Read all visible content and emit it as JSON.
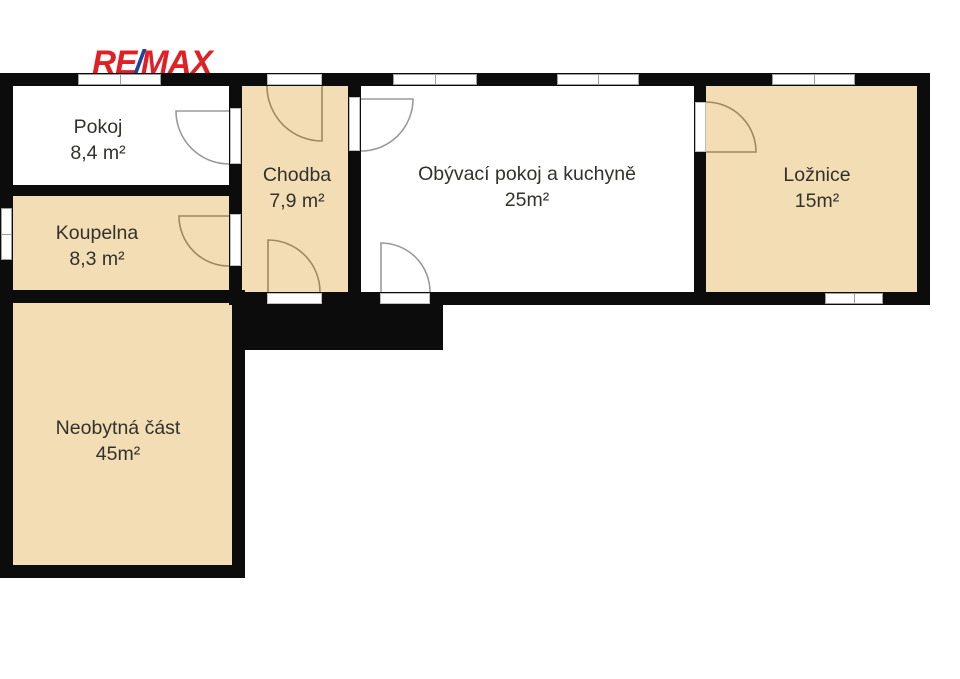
{
  "logo": {
    "part1": "RE",
    "slash": "/",
    "part2": "MAX"
  },
  "colors": {
    "wall": "#0c0c0c",
    "room_fill": "#f2ddb5",
    "text": "#33312c",
    "logo_red": "#e02025",
    "logo_blue": "#1b449c",
    "window_border": "#9e9e9e",
    "door_arc_tan": "#9c8a62",
    "door_arc_gray": "#9a9a9a"
  },
  "rooms": [
    {
      "name": "Pokoj",
      "area": "8,4 m²"
    },
    {
      "name": "Koupelna",
      "area": "8,3 m²"
    },
    {
      "name": "Chodba",
      "area": "7,9 m²"
    },
    {
      "name": "Obývací pokoj a kuchyně",
      "area": "25m²"
    },
    {
      "name": "Ložnice",
      "area": "15m²"
    },
    {
      "name": "Neobytná část",
      "area": "45m²"
    }
  ]
}
